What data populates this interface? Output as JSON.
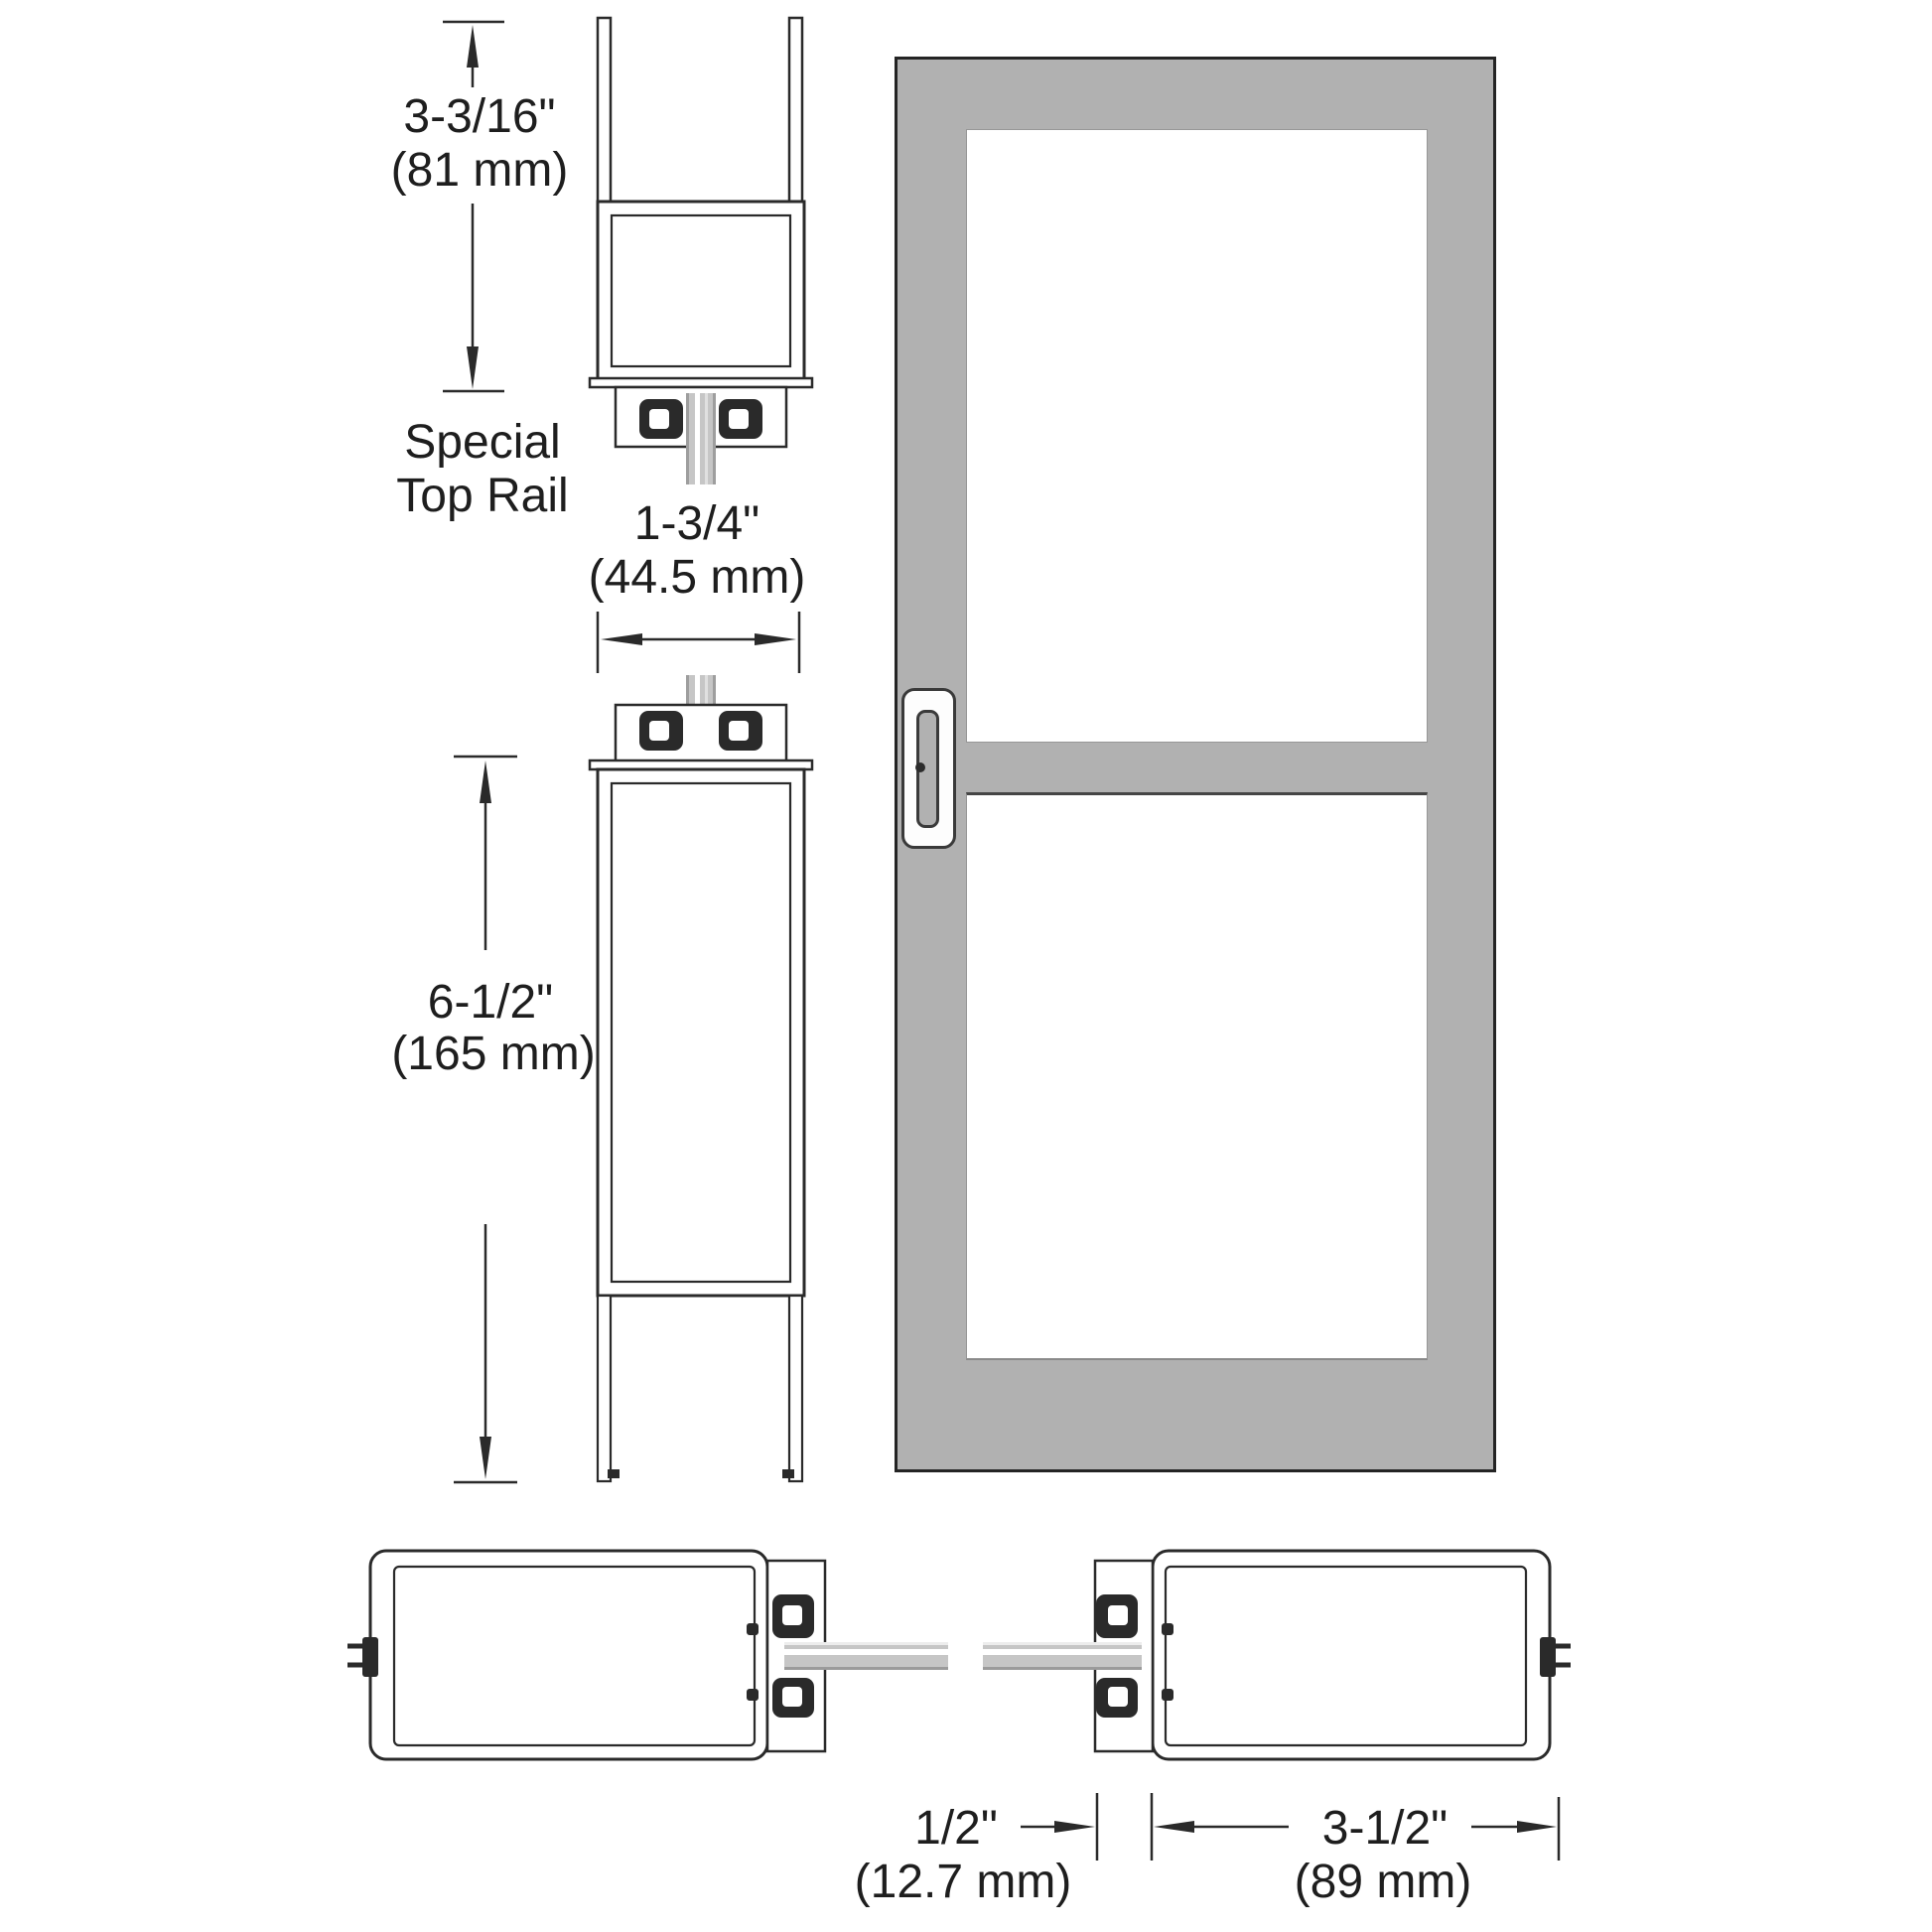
{
  "diagram": {
    "title": "Aluminum glass entrance door – stile and rail cross-section diagram",
    "labels": {
      "special_top_rail_line1": "Special",
      "special_top_rail_line2": "Top Rail"
    },
    "dimensions": {
      "top_rail": {
        "inches": "3-3/16\"",
        "metric": "(81 mm)"
      },
      "door_thickness": {
        "inches": "1-3/4\"",
        "metric": "(44.5 mm)"
      },
      "bottom_rail": {
        "inches": "6-1/2\"",
        "metric": "(165 mm)"
      },
      "glass_gap": {
        "inches": "1/2\"",
        "metric": "(12.7 mm)"
      },
      "stile_width": {
        "inches": "3-1/2\"",
        "metric": "(89 mm)"
      }
    }
  },
  "colors": {
    "line": "#2a2a2a",
    "text": "#1e1e1e",
    "door_gray": "#b1b1b1",
    "glass_gray": "#c6c6c6",
    "background": "#ffffff"
  }
}
